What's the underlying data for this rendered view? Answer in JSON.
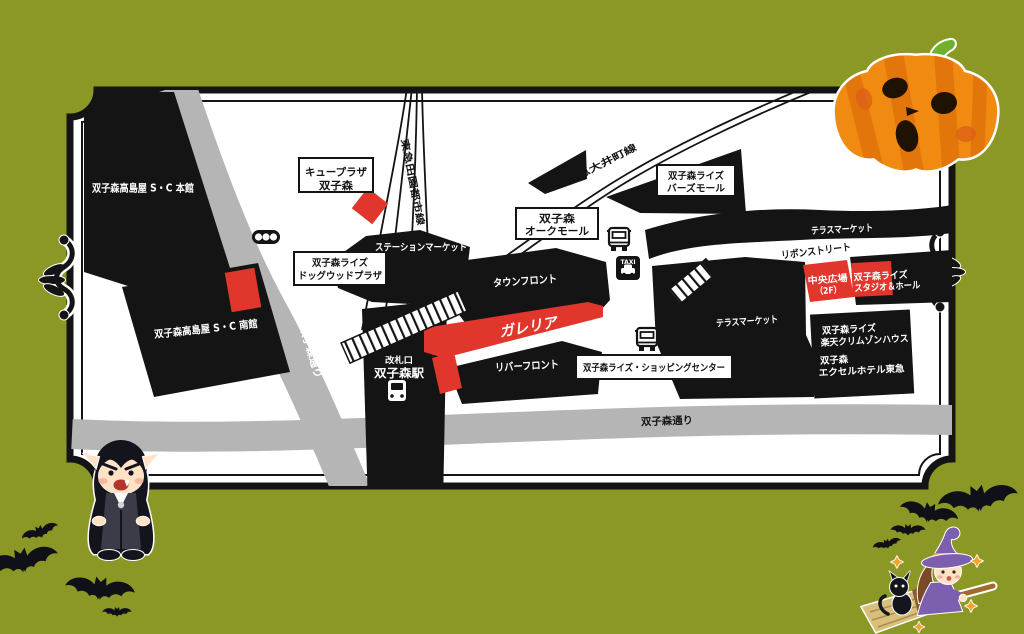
{
  "colors": {
    "background": "#8b9826",
    "map_bg": "#ffffff",
    "building": "#141414",
    "road": "#b5b5b5",
    "accent_red": "#e0362b",
    "pumpkin_orange": "#f08a10",
    "witch_purple": "#7d5fb0"
  },
  "map": {
    "stores": {
      "takashimaya_main": "双子森高島屋 S・C 本館",
      "takashimaya_south": "双子森高島屋 S・C 南館",
      "qplaza_line1": "キュープラザ",
      "qplaza_line2": "双子森",
      "station_market": "ステーションマーケット",
      "dogwood_line1": "双子森ライズ",
      "dogwood_line2": "ドッグウッドプラザ",
      "oak_mall_line1": "双子森",
      "oak_mall_line2": "オークモール",
      "birds_mall_line1": "双子森ライズ",
      "birds_mall_line2": "バーズモール",
      "town_front": "タウンフロント",
      "galleria": "ガレリア",
      "river_front": "リバーフロント",
      "shopping_center": "双子森ライズ・ショッピングセンター",
      "terrace_market_upper": "テラスマーケット",
      "terrace_market_lower": "テラスマーケット",
      "ribbon_street": "リボンストリート",
      "central_plaza_line1": "中央広場",
      "central_plaza_line2": "（2F）",
      "studio_hall_line1": "双子森ライズ",
      "studio_hall_line2": "スタジオ＆ホール",
      "rakuten_line1": "双子森ライズ",
      "rakuten_line2": "楽天クリムゾンハウス",
      "hotel_line1": "双子森",
      "hotel_line2": "エクセルホテル東急"
    },
    "station": {
      "gate_label": "改札口",
      "name": "双子森駅"
    },
    "railways": {
      "den_en_toshi_line": "東急田園都市線",
      "oimachi_line": "東急大井町線"
    },
    "roads": {
      "west_street": "双子森通り",
      "south_street": "双子森通り"
    },
    "icons": {
      "taxi_label": "TAXI"
    }
  }
}
